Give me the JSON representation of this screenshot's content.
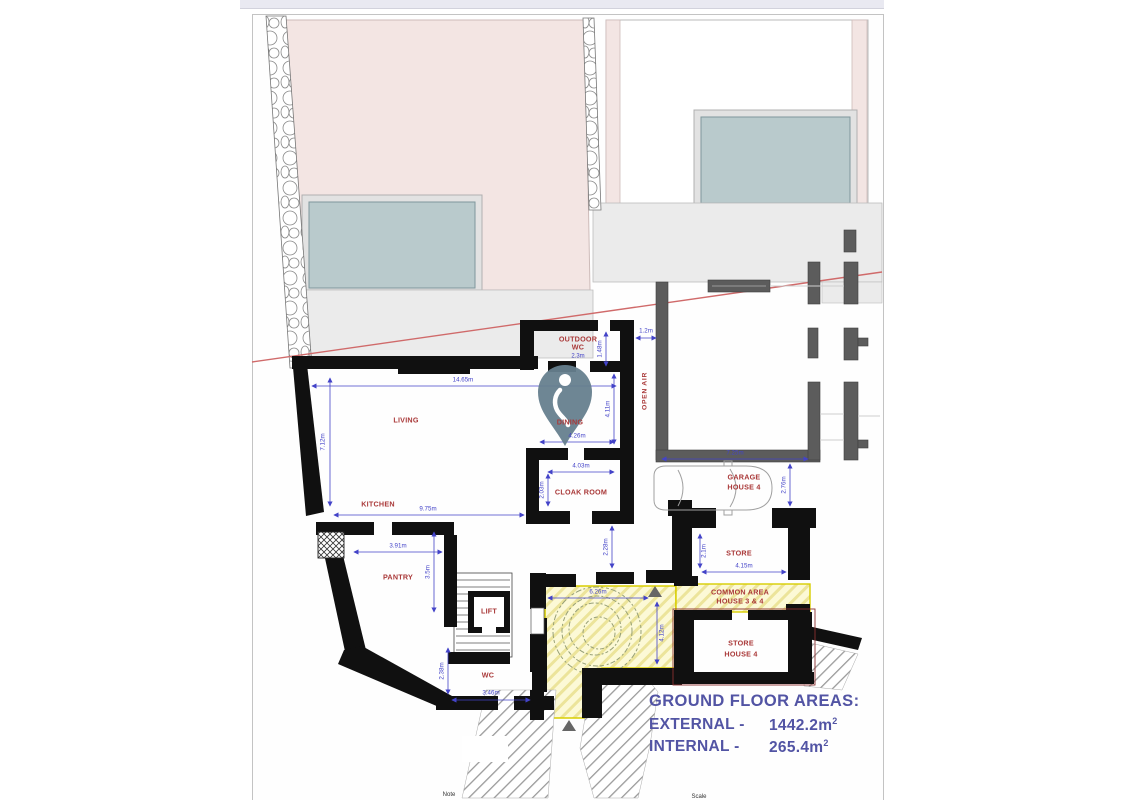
{
  "plan": {
    "rooms": {
      "living": "LIVING",
      "kitchen": "KITCHEN",
      "dining": "DINING",
      "outdoor_wc_1": "OUTDOOR",
      "outdoor_wc_2": "WC",
      "outdoor_wc_dim": "2.3m",
      "cloak": "CLOAK ROOM",
      "pantry": "PANTRY",
      "lift": "LIFT",
      "wc": "WC",
      "open_air": "OPEN AIR",
      "garage_1": "GARAGE",
      "garage_2": "HOUSE 4",
      "store": "STORE",
      "common_1": "COMMON AREA",
      "common_2": "HOUSE 3 & 4",
      "store4_1": "STORE",
      "store4_2": "HOUSE 4"
    },
    "dimensions": [
      "14.65m",
      "7.12m",
      "9.75m",
      "4.26m",
      "4.11m",
      "1.48m",
      "1.2m",
      "4.03m",
      "2.03m",
      "7.25m",
      "2.76m",
      "3.91m",
      "3.5m",
      "2.38m",
      "3.46m",
      "2.28m",
      "6.26m",
      "4.12m",
      "2.1m",
      "4.15m"
    ]
  },
  "areas_panel": {
    "title": "GROUND FLOOR AREAS:",
    "rows": [
      {
        "label": "EXTERNAL -",
        "value": "1442.2m",
        "sup": "2"
      },
      {
        "label": "INTERNAL -",
        "value": "265.4m",
        "sup": "2"
      }
    ]
  },
  "footer": {
    "note": "Note",
    "scale": "Scale"
  },
  "colors": {
    "wall": "#101010",
    "neighbor_wall": "#5c5c5c",
    "dimension_text": "#4343c8",
    "room_text": "#a93838",
    "boundary_line": "#d06a6a",
    "building_fill": "#f3e5e3",
    "glazing_fill": "#b9cacc",
    "terrace_fill": "#ebebeb",
    "courtyard_fill": "#fcf9d6",
    "courtyard_border": "#d8ce00",
    "areas_text": "#5254a4",
    "pin_fill": "#66808e"
  }
}
